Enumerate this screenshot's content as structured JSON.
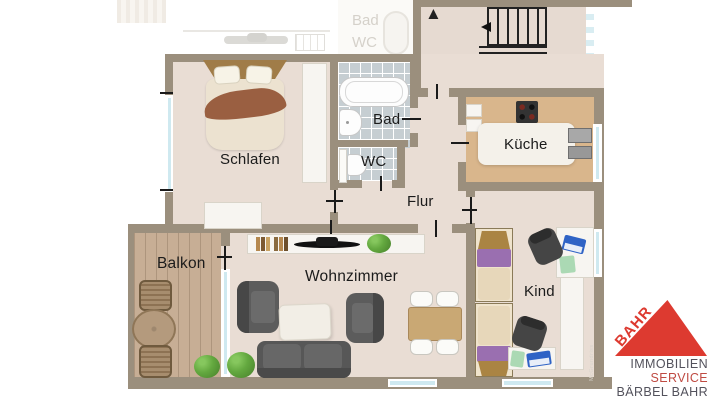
{
  "rooms": {
    "schlafen": "Schlafen",
    "bad": "Bad",
    "wc": "WC",
    "kueche": "Küche",
    "flur": "Flur",
    "wohnzimmer": "Wohnzimmer",
    "kind": "Kind",
    "balkon": "Balkon"
  },
  "faded_rooms": {
    "bad": "Bad",
    "wc": "WC"
  },
  "icons": {
    "stairs_up": "▲",
    "stairs_down": "▼"
  },
  "watermark": "McGrundriss",
  "logo": {
    "brand": "BAHR",
    "line1": "IMMOBILIEN",
    "line2": "SERVICE",
    "line3": "BÄRBEL BAHR"
  },
  "palette": {
    "wall": "#9b8f7d",
    "floor": "#e9ddd4",
    "floor_stair": "#e6dad1",
    "kitchen_floor": "#d9b68c",
    "balcony_deck": "#c7ae95",
    "tile": "#c6ced2",
    "window_glass": "#cfe9f0",
    "furniture_dark": "#575757",
    "wood": "#a07c48",
    "purple": "#9a6fb0",
    "blanket": "#9a5f41",
    "cream": "#ece2d0",
    "white_furniture": "#f7f5f1",
    "laptop_blue": "#2f63c5",
    "pad_green": "#abd9b4",
    "logo_red": "#dd3a30",
    "logo_text_dark": "#53525c",
    "logo_service_red": "#bf4a42",
    "label_color": "#1b1b1b",
    "faded_label": "#d5d1ca"
  }
}
